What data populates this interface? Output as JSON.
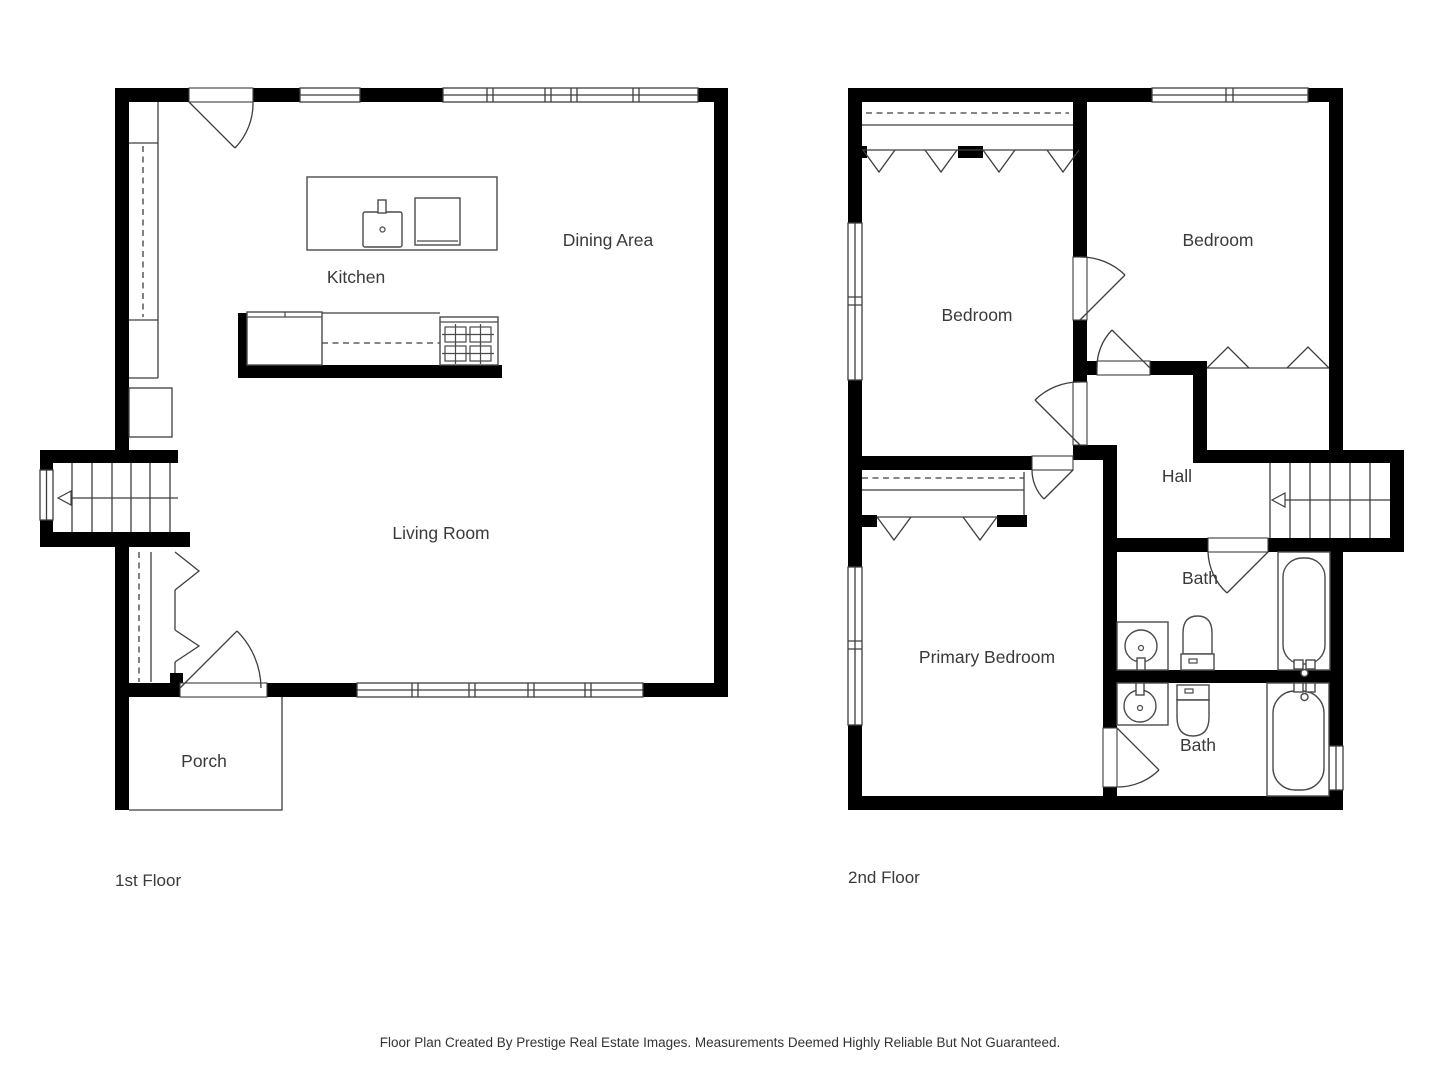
{
  "floors": {
    "first": {
      "caption": "1st Floor",
      "rooms": {
        "kitchen": "Kitchen",
        "dining_area": "Dining Area",
        "living_room": "Living Room",
        "porch": "Porch"
      }
    },
    "second": {
      "caption": "2nd Floor",
      "rooms": {
        "bedroom_left": "Bedroom",
        "bedroom_right": "Bedroom",
        "hall": "Hall",
        "primary_bedroom": "Primary Bedroom",
        "bath_upper": "Bath",
        "bath_lower": "Bath"
      }
    }
  },
  "footer": {
    "disclaimer": "Floor Plan Created By Prestige Real Estate Images. Measurements Deemed Highly Reliable But Not Guaranteed."
  },
  "colors": {
    "background": "#ffffff",
    "wall": "#000000",
    "thin_line": "#3e3e3e",
    "fixture_line": "#4a4a4a",
    "text": "#3a3a3a"
  }
}
